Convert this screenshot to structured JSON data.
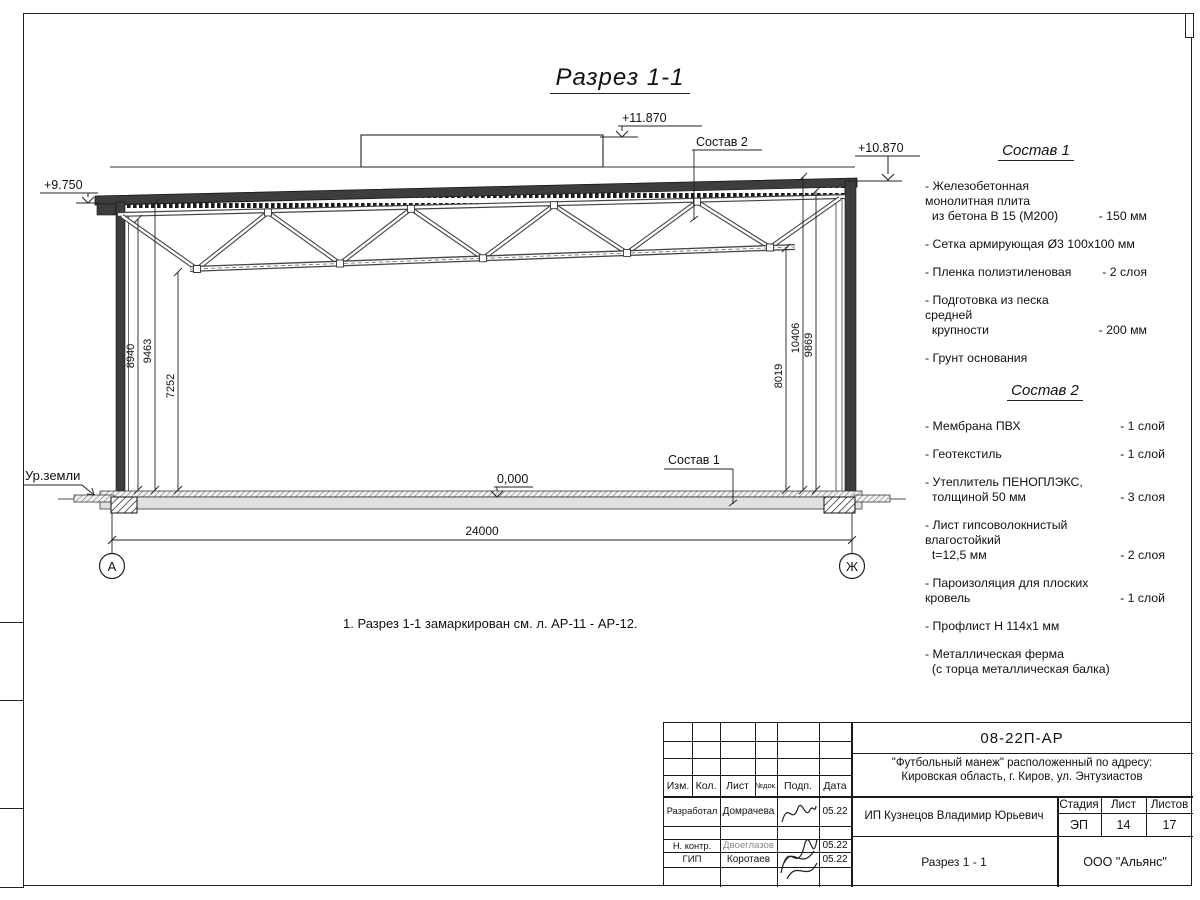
{
  "sheet": {
    "title": "Разрез 1-1",
    "note": "1. Разрез 1-1 замаркирован см. л. АР-11 - АР-12."
  },
  "drawing": {
    "elevations": {
      "eave_left": "+9.750",
      "box_top": "+11.870",
      "roof_right": "+10.870",
      "floor": "0,000",
      "ground": "Ур.земли"
    },
    "leaders": {
      "roof": "Состав 2",
      "floor": "Состав 1"
    },
    "dims": {
      "left": [
        "8940",
        "9463",
        "7252"
      ],
      "right": [
        "8019",
        "10406",
        "9869"
      ],
      "span": "24000"
    },
    "axes": {
      "left": "А",
      "right": "Ж"
    }
  },
  "sostav1": {
    "title": "Состав 1",
    "items": [
      {
        "name": "- Железобетонная  монолитная плита\n  из бетона В 15 (М200)",
        "value": "- 150 мм"
      },
      {
        "name": "- Сетка армирующая Ø3 100х100 мм",
        "value": ""
      },
      {
        "name": "- Пленка полиэтиленовая",
        "value": "-  2 слоя"
      },
      {
        "name": "- Подготовка из песка средней\n  крупности",
        "value": "- 200 мм"
      },
      {
        "name": "- Грунт основания",
        "value": ""
      }
    ]
  },
  "sostav2": {
    "title": "Состав 2",
    "items": [
      {
        "name": "- Мембрана ПВХ",
        "value": "- 1 слой"
      },
      {
        "name": "- Геотекстиль",
        "value": "- 1 слой"
      },
      {
        "name": "- Утеплитель ПЕНОПЛЭКС,\n  толщиной 50 мм",
        "value": "- 3 слоя"
      },
      {
        "name": "- Лист гипсоволокнистый влагостойкий\n  t=12,5 мм",
        "value": "- 2 слоя"
      },
      {
        "name": "- Пароизоляция для плоских кровель",
        "value": "- 1 слой"
      },
      {
        "name": "- Профлист Н 114х1 мм",
        "value": ""
      },
      {
        "name": "- Металлическая ферма\n  (с торца металлическая балка)",
        "value": ""
      }
    ]
  },
  "stamp": {
    "doc_number": "08-22П-АР",
    "project_line1": "\"Футбольный манеж\" расположенный по адресу:",
    "project_line2": "Кировская область, г. Киров, ул. Энтузиастов",
    "headers": {
      "izm": "Изм.",
      "kol": "Кол.",
      "list": "Лист",
      "ndok": "№док.",
      "podp": "Подп.",
      "data": "Дата"
    },
    "rows": [
      {
        "role": "Разработал",
        "name": "Домрачева",
        "date": "05.22"
      },
      {
        "role": "Н. контр.",
        "name": "Двоеглазов",
        "date": "05.22"
      },
      {
        "role": "ГИП",
        "name": "Коротаев",
        "date": "05.22"
      }
    ],
    "client": "ИП Кузнецов Владимир Юрьевич",
    "stage_label": "Стадия",
    "sheet_label": "Лист",
    "sheets_label": "Листов",
    "stage": "ЭП",
    "sheet": "14",
    "sheets": "17",
    "drawing_title": "Разрез 1 - 1",
    "company": "ООО \"Альянс\""
  }
}
